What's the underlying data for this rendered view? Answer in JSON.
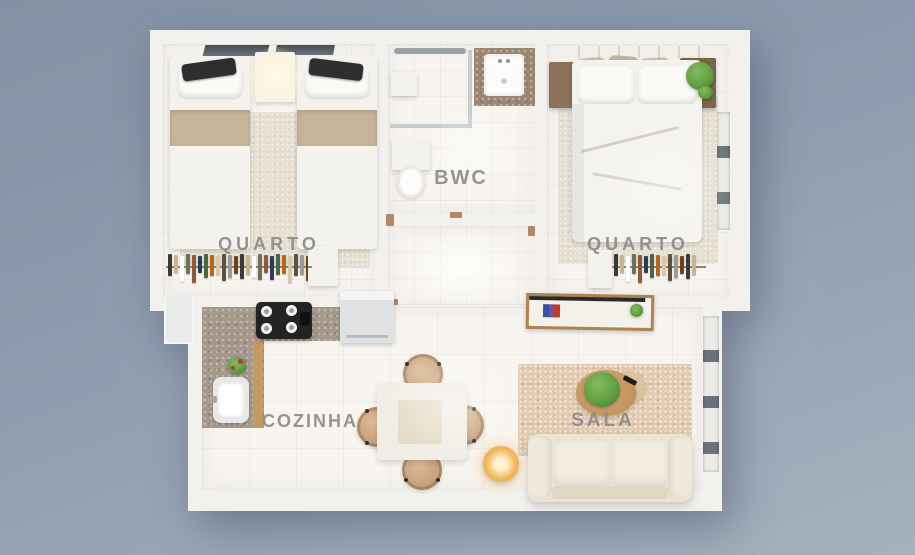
{
  "scene": {
    "type": "apartment-floor-plan-3d-top-view",
    "language": "pt-BR",
    "visible_text": [
      "QUARTO",
      "BWC",
      "QUARTO",
      "COZINHA",
      "SALA"
    ]
  },
  "rooms": {
    "bedroom_left": {
      "label": "QUARTO"
    },
    "bathroom": {
      "label": "BWC"
    },
    "bedroom_right": {
      "label": "QUARTO"
    },
    "kitchen": {
      "label": "COZINHA"
    },
    "living_room": {
      "label": "SALA"
    }
  },
  "palette": {
    "bg-top": "#8391a4",
    "bg-bottom": "#a6b1be",
    "wall": "#f2f1ee",
    "floor": "#f8f5f1",
    "label": "#8c8c8c",
    "granite": "#a6988a",
    "wood": "#c49a62",
    "rug": "#e6dfd2",
    "sala-rug": "#e3cbb3",
    "sofa": "#ebe4d4",
    "bed": "#f4f2ec",
    "blanket": "#c6b499",
    "plant": "#5f9c40",
    "lamp": "#f2bc62",
    "cooktop": "#232323",
    "window-dark": "#6b727a"
  },
  "palette_clothes": [
    "#3a3a3a",
    "#c8b48e",
    "#ffffff",
    "#6b705c",
    "#8d5a3a",
    "#2e3d55",
    "#4a6741",
    "#b5651d",
    "#d9c7a7",
    "#5e503f",
    "#9a9a9a",
    "#704214"
  ]
}
